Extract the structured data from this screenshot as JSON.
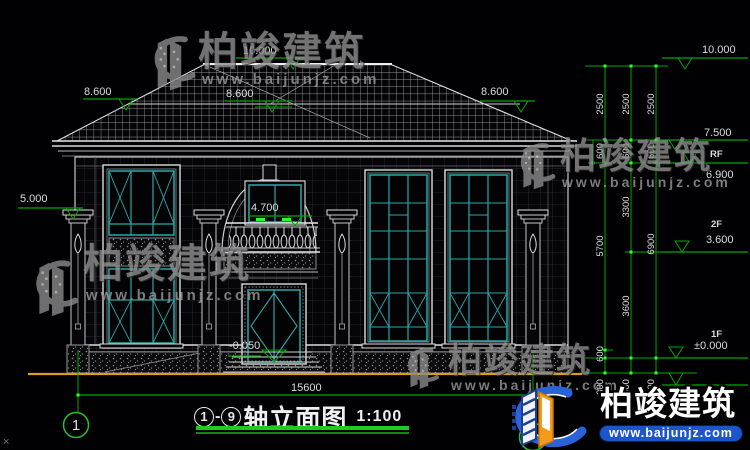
{
  "left_levels": {
    "l8600_left": "8.600",
    "l10000_top": "10.000",
    "l8600_mid": "8.600",
    "l8600_right": "8.600",
    "l5000": "5.000",
    "l4700": "4.700",
    "lminus0050": "-0.050"
  },
  "right_levels": {
    "l10000": "10.000",
    "l7500": "7.500",
    "rf": "RF",
    "l6900": "6.900",
    "f2": "2F",
    "l3600": "3.600",
    "f1": "1F",
    "lzero": "±0.000"
  },
  "right_dims": {
    "d2500_1": "2500",
    "d2500_2": "2500",
    "d2500_3": "2500",
    "d600_1": "600",
    "d600_2": "600",
    "d600_3": "600",
    "d3300": "3300",
    "d5700": "5700",
    "d3600": "3600",
    "d6900": "6900",
    "d600_4": "600",
    "d300_1": "300",
    "d300_2": "300",
    "d300_3": "300"
  },
  "bottom": {
    "width_dim": "15600",
    "axis_left": "1",
    "axis_right": "9",
    "title_text": "轴立面图",
    "title_scale": "1:100",
    "corner_mark": "×"
  },
  "watermark": {
    "brand": "柏竣建筑",
    "url": "www.baijunjz.com"
  },
  "logo": {
    "brand": "柏竣建筑",
    "url": "www.baijunjz.com"
  },
  "colors": {
    "window_teal": "#2aa8a8",
    "dim_green": "#00a800",
    "bright_green": "#2aff2a",
    "ground_yellow": "#d7a017",
    "logo_blue": "#2a62d9",
    "logo_orange": "#f59a1d",
    "watermark_gray": "#8f8f8f"
  }
}
